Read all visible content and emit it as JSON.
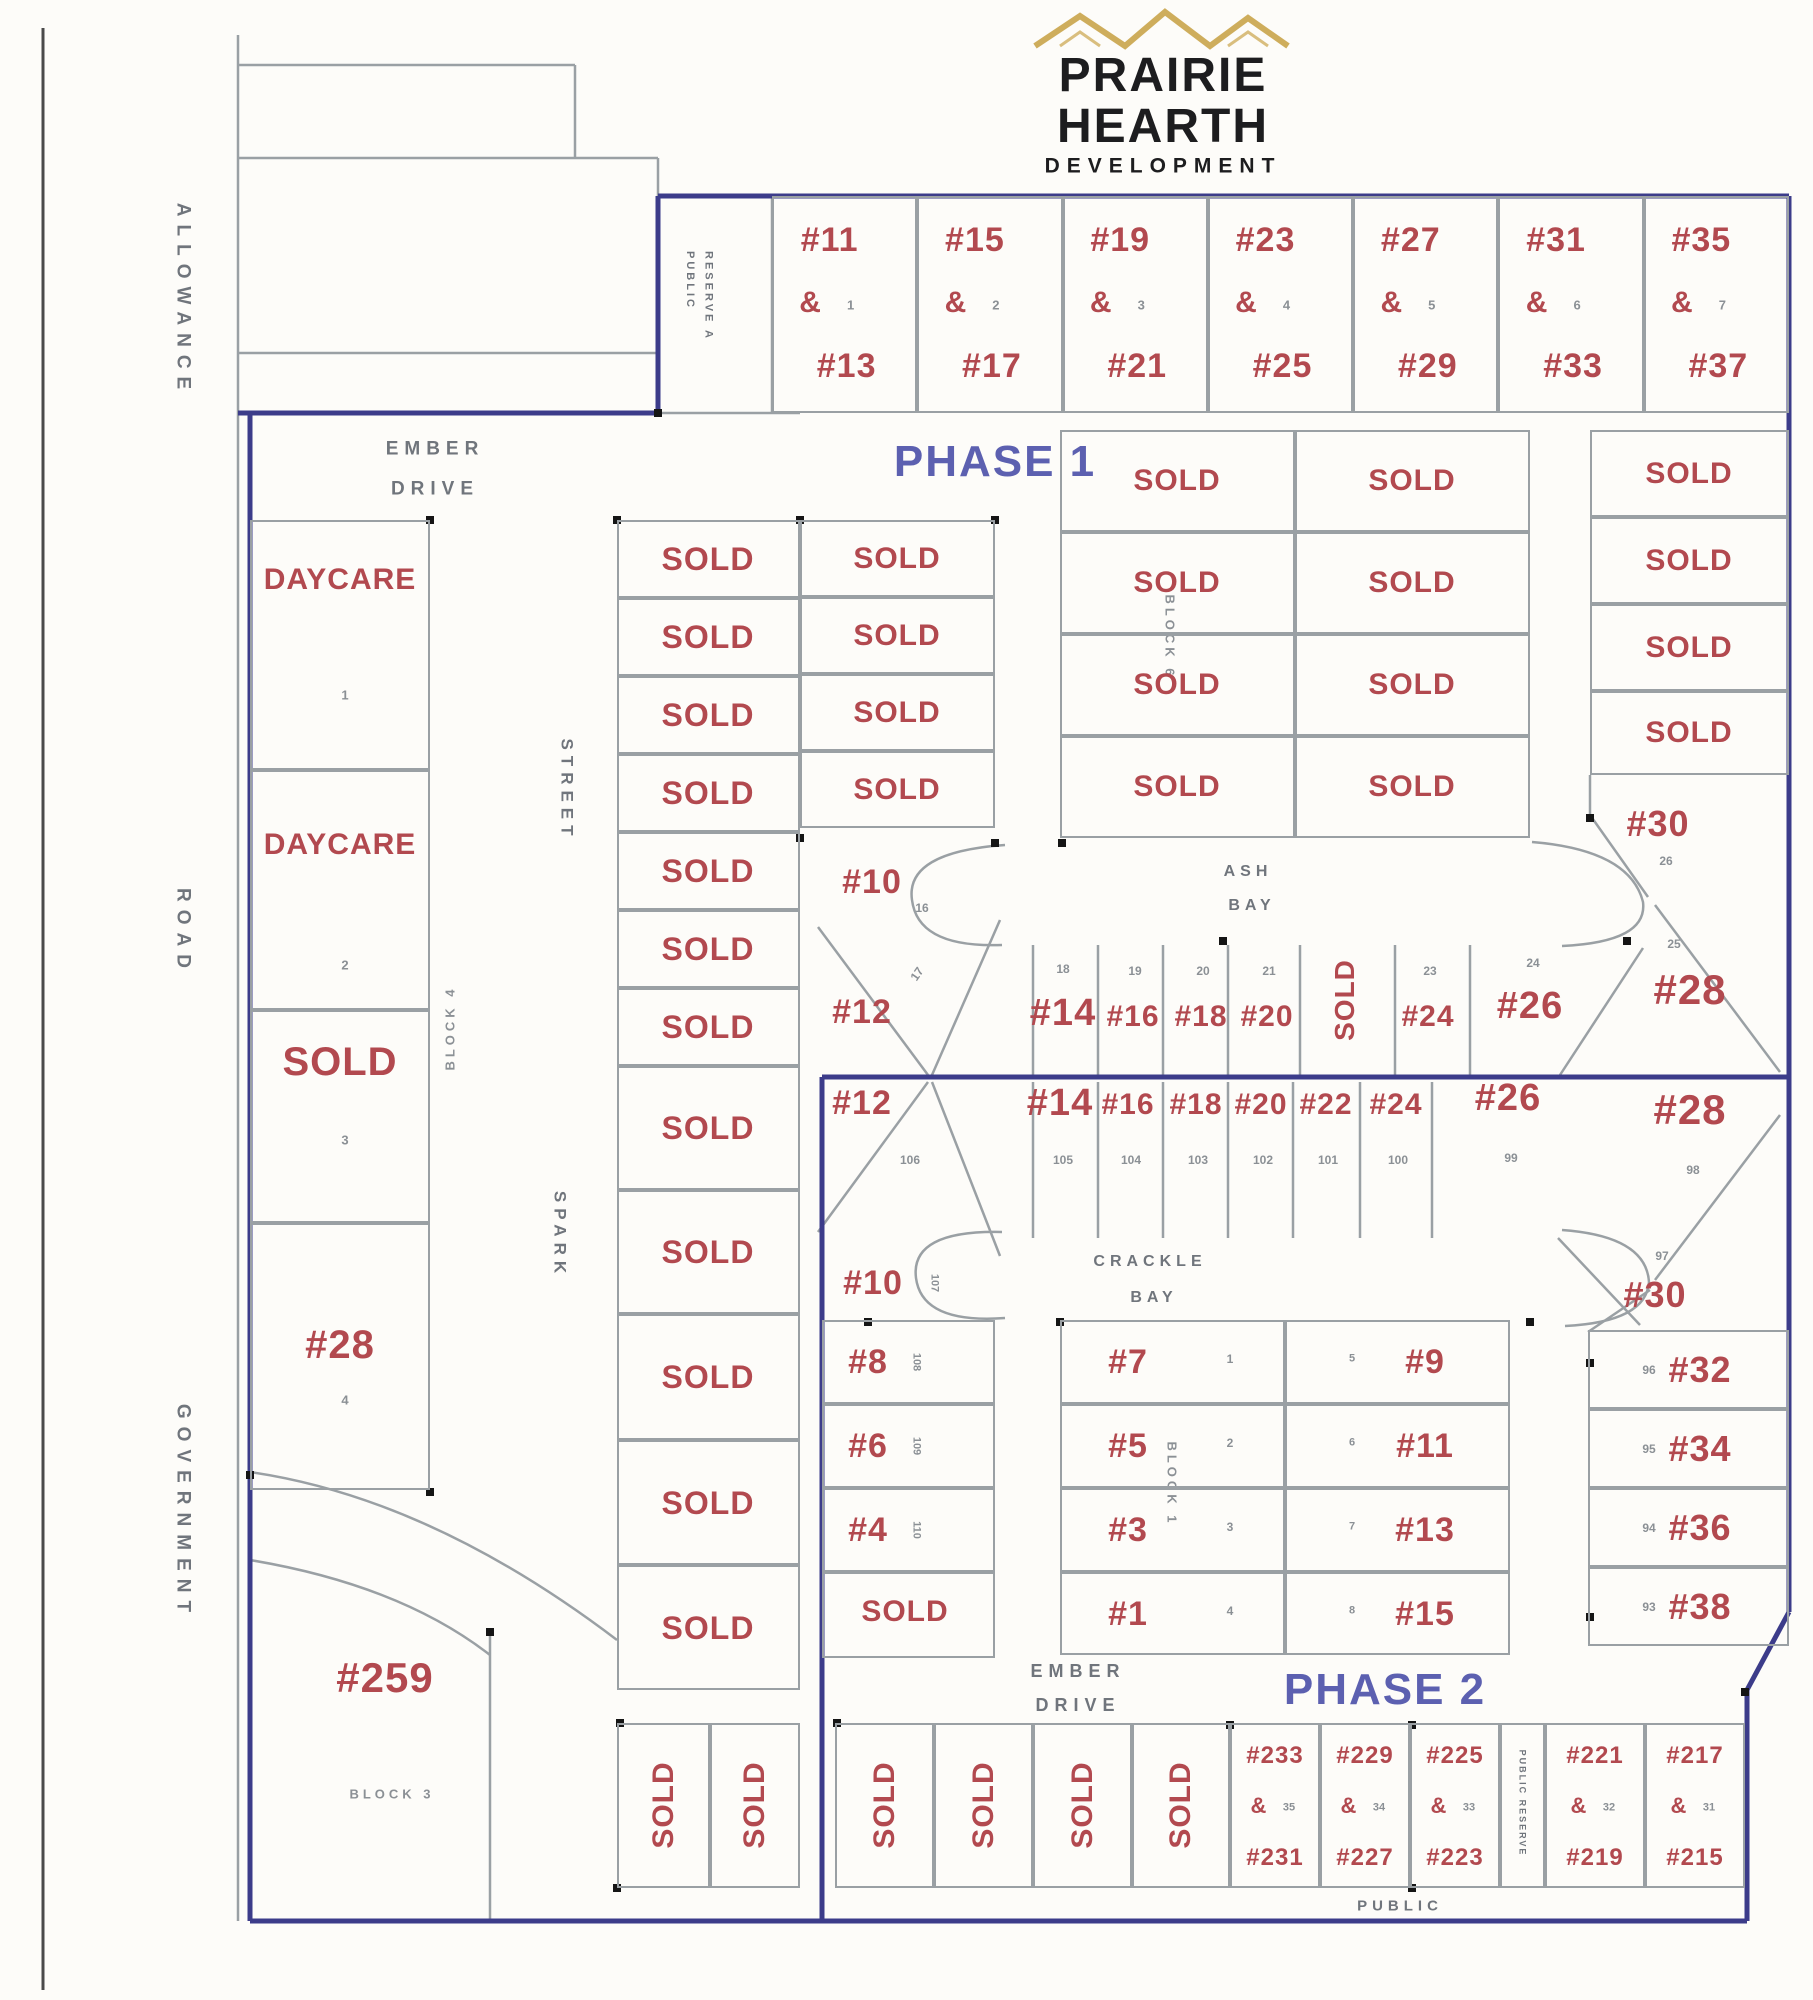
{
  "logo": {
    "line1": "PRAIRIE",
    "line2": "HEARTH",
    "line3": "DEVELOPMENT"
  },
  "phases": {
    "phase1": "PHASE 1",
    "phase2": "PHASE 2"
  },
  "streets": {
    "ember_top_l1": "EMBER",
    "ember_top_l2": "DRIVE",
    "ember_bottom_l1": "EMBER",
    "ember_bottom_l2": "DRIVE",
    "spark": "SPARK",
    "street": "STREET",
    "ash_l1": "ASH",
    "ash_l2": "BAY",
    "crackle_l1": "CRACKLE",
    "crackle_l2": "BAY",
    "public": "PUBLIC",
    "reserve_a": "PUBLIC\nRESERVE A",
    "reserve_b": "PUBLIC RESERVE",
    "allowance": "ALLOWANCE",
    "road": "ROAD",
    "government": "GOVERNMENT"
  },
  "blocks": {
    "block1": "BLOCK 1",
    "block3": "BLOCK 3",
    "block4": "BLOCK 4",
    "block6": "BLOCK 6"
  },
  "top_row": [
    {
      "t": "#11",
      "a": "&",
      "n": "1",
      "b": "#13"
    },
    {
      "t": "#15",
      "a": "&",
      "n": "2",
      "b": "#17"
    },
    {
      "t": "#19",
      "a": "&",
      "n": "3",
      "b": "#21"
    },
    {
      "t": "#23",
      "a": "&",
      "n": "4",
      "b": "#25"
    },
    {
      "t": "#27",
      "a": "&",
      "n": "5",
      "b": "#29"
    },
    {
      "t": "#31",
      "a": "&",
      "n": "6",
      "b": "#33"
    },
    {
      "t": "#35",
      "a": "&",
      "n": "7",
      "b": "#37"
    }
  ],
  "left_col": [
    {
      "label": "DAYCARE",
      "n": "1"
    },
    {
      "label": "DAYCARE",
      "n": "2"
    },
    {
      "label": "SOLD",
      "n": "3"
    },
    {
      "label": "#28",
      "n": "4"
    }
  ],
  "lot259": {
    "label": "#259"
  },
  "spark_col": [
    "SOLD",
    "SOLD",
    "SOLD",
    "SOLD",
    "SOLD",
    "SOLD",
    "SOLD",
    "SOLD",
    "SOLD",
    "SOLD",
    "SOLD",
    "SOLD"
  ],
  "col3": {
    "solds": [
      "SOLD",
      "SOLD",
      "SOLD",
      "SOLD"
    ],
    "lot10": {
      "label": "#10",
      "n": "16"
    },
    "lot12": {
      "label": "#12",
      "n": "17"
    }
  },
  "ash_block": [
    "SOLD",
    "SOLD",
    "SOLD",
    "SOLD",
    "SOLD",
    "SOLD",
    "SOLD",
    "SOLD"
  ],
  "right_p1": {
    "solds": [
      "SOLD",
      "SOLD",
      "SOLD",
      "SOLD"
    ],
    "lot30": {
      "label": "#30",
      "n": "26"
    }
  },
  "fan_upper": [
    {
      "label": "#14",
      "n": "18"
    },
    {
      "label": "#16",
      "n": "19"
    },
    {
      "label": "#18",
      "n": "20"
    },
    {
      "label": "#20",
      "n": "21"
    },
    {
      "label": "SOLD",
      "n": ""
    },
    {
      "label": "#24",
      "n": "23"
    },
    {
      "label": "#26",
      "n": "24"
    },
    {
      "label": "#28",
      "n": "25"
    }
  ],
  "fan_lower": [
    {
      "label": "#12",
      "n": "106"
    },
    {
      "label": "#14",
      "n": "105"
    },
    {
      "label": "#16",
      "n": "104"
    },
    {
      "label": "#18",
      "n": "103"
    },
    {
      "label": "#20",
      "n": "102"
    },
    {
      "label": "#22",
      "n": "101"
    },
    {
      "label": "#24",
      "n": "100"
    },
    {
      "label": "#26",
      "n": "99"
    },
    {
      "label": "#28",
      "n": "98"
    }
  ],
  "crackle": {
    "lot10": {
      "label": "#10",
      "n": "107"
    },
    "lots": [
      {
        "label": "#8",
        "n": "108"
      },
      {
        "label": "#6",
        "n": "109"
      },
      {
        "label": "#4",
        "n": "110"
      }
    ],
    "sold": "SOLD"
  },
  "block1": {
    "left": [
      {
        "label": "#7",
        "n": "1"
      },
      {
        "label": "#5",
        "n": "2"
      },
      {
        "label": "#3",
        "n": "3"
      },
      {
        "label": "#1",
        "n": "4"
      }
    ],
    "right": [
      {
        "label": "#9",
        "n": "5"
      },
      {
        "label": "#11",
        "n": "6"
      },
      {
        "label": "#13",
        "n": "7"
      },
      {
        "label": "#15",
        "n": "8"
      }
    ]
  },
  "right_p2": {
    "lot30": {
      "label": "#30",
      "n": "97"
    },
    "lots": [
      {
        "label": "#32",
        "n": "96"
      },
      {
        "label": "#34",
        "n": "95"
      },
      {
        "label": "#36",
        "n": "94"
      },
      {
        "label": "#38",
        "n": "93"
      }
    ]
  },
  "bottom": {
    "solds_left": [
      "SOLD",
      "SOLD"
    ],
    "solds_right": [
      "SOLD",
      "SOLD",
      "SOLD",
      "SOLD"
    ],
    "duplexes": [
      {
        "t": "#233",
        "a": "&",
        "n": "35",
        "b": "#231"
      },
      {
        "t": "#229",
        "a": "&",
        "n": "34",
        "b": "#227"
      },
      {
        "t": "#225",
        "a": "&",
        "n": "33",
        "b": "#223"
      },
      {
        "t": "#221",
        "a": "&",
        "n": "32",
        "b": "#219"
      },
      {
        "t": "#217",
        "a": "&",
        "n": "31",
        "b": "#215"
      }
    ]
  },
  "colors": {
    "lot_red": "#b2494f",
    "boundary_blue": "#3c3c8a",
    "phase_blue": "#5c60b0",
    "line_gray": "#9aa0a4",
    "text_gray": "#7e838a",
    "roof_gold": "#c9a44a",
    "ink_black": "#1d1d1f"
  }
}
